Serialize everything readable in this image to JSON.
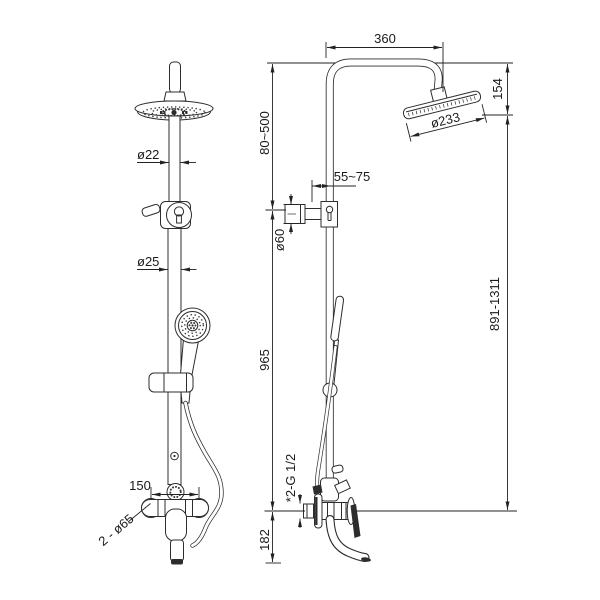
{
  "colors": {
    "background": "#ffffff",
    "line": "#2d2d2d",
    "label": "#1a1a1a"
  },
  "front_view": {
    "labels": {
      "upper_pipe_diameter": "ø22",
      "lower_pipe_diameter": "ø25",
      "inlet_spacing": "150",
      "escutcheons": "2 - ø65"
    }
  },
  "side_view": {
    "labels": {
      "arm_reach": "360",
      "head_height": "154",
      "head_diameter": "ø233",
      "upper_adjust_range": "80~500",
      "wall_clearance": "55~75",
      "bracket_diameter": "ø60",
      "total_height_range": "891-1311",
      "bracket_to_inlet": "965",
      "inlet_thread": "*2-G 1/2",
      "inlet_to_spout": "182"
    }
  }
}
